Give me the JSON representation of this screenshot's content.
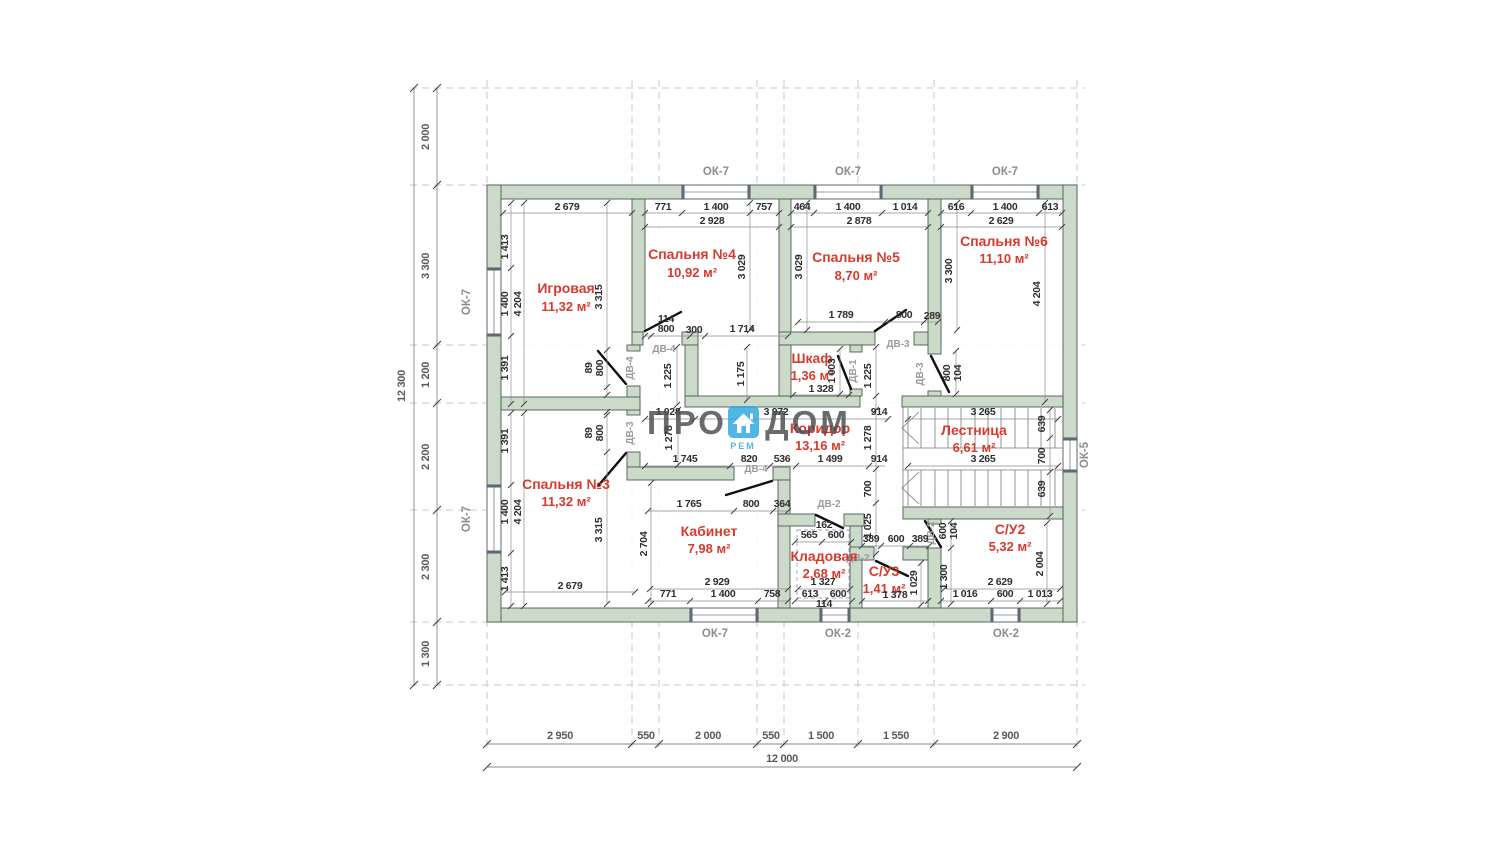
{
  "logo": {
    "pro": "ПРО",
    "dom": "ДОМ",
    "rem": "РЕМ"
  },
  "rooms": {
    "igrovaya": {
      "name": "Игровая",
      "area": "11,32 м²"
    },
    "b4": {
      "name": "Спальня №4",
      "area": "10,92 м²"
    },
    "b5": {
      "name": "Спальня №5",
      "area": "8,70 м²"
    },
    "b6": {
      "name": "Спальня №6",
      "area": "11,10 м²"
    },
    "shkaf": {
      "name": "Шкаф",
      "area": "1,36 м²"
    },
    "koridor": {
      "name": "Коридор",
      "area": "13,16 м²"
    },
    "lestnica": {
      "name": "Лестница",
      "area": "6,61 м²"
    },
    "b3": {
      "name": "Спальня №3",
      "area": "11,32 м²"
    },
    "kabinet": {
      "name": "Кабинет",
      "area": "7,98 м²"
    },
    "kladovaya": {
      "name": "Кладовая",
      "area": "2,68 м²"
    },
    "su3": {
      "name": "С/У3",
      "area": "1,41 м²"
    },
    "su2": {
      "name": "С/У2",
      "area": "5,32 м²"
    }
  },
  "win": {
    "ok7": "ОК-7",
    "ok2": "ОК-2",
    "ok5": "ОК-5"
  },
  "door": {
    "d1": "ДВ-1",
    "d2": "ДВ-2",
    "d3": "ДВ-3",
    "d4": "ДВ-4"
  },
  "axisLeft": {
    "segs": [
      "2 000",
      "3 300",
      "1 200",
      "2 200",
      "2 300",
      "1 300"
    ],
    "total": "12 300"
  },
  "axisBottom": {
    "segs": [
      "2 950",
      "550",
      "2 000",
      "550",
      "1 500",
      "1 550",
      "2 900"
    ],
    "total": "12 000"
  },
  "dims": {
    "top": [
      "2 679",
      "771",
      "1 400",
      "757",
      "464",
      "1 400",
      "1 014",
      "616",
      "1 400",
      "613"
    ],
    "top2": [
      "2 928",
      "2 878",
      "2 629"
    ],
    "ig": [
      "1 413",
      "1 400",
      "4 204",
      "1 391",
      "3 315"
    ],
    "b4": [
      "3 029",
      "114",
      "800",
      "300",
      "1 714"
    ],
    "b5": [
      "3 029",
      "3 300",
      "1 789",
      "800",
      "289"
    ],
    "b6": [
      "4 204"
    ],
    "wd": [
      "89",
      "800",
      "89",
      "800"
    ],
    "nook": [
      "1 225",
      "1 175",
      "1 328",
      "1 003",
      "1 225",
      "800",
      "104"
    ],
    "cor": [
      "1 028",
      "3 972",
      "914",
      "1 278",
      "1 278",
      "914",
      "1 745",
      "820",
      "536",
      "1 499",
      "700",
      "1 025"
    ],
    "st": [
      "3 265",
      "3 265",
      "639",
      "700",
      "639"
    ],
    "b3": [
      "1 391",
      "1 400",
      "4 204",
      "1 413",
      "3 315",
      "2 679"
    ],
    "cab": [
      "2 704",
      "1 765",
      "800",
      "364",
      "2 929",
      "771",
      "1 400",
      "758"
    ],
    "kl": [
      "162",
      "565",
      "600",
      "1 327",
      "613",
      "600",
      "114"
    ],
    "su3": [
      "389",
      "600",
      "389",
      "1 378",
      "1 029"
    ],
    "su2": [
      "600",
      "104",
      "1 300",
      "2 004",
      "2 629",
      "1 016",
      "600",
      "1 013"
    ]
  }
}
